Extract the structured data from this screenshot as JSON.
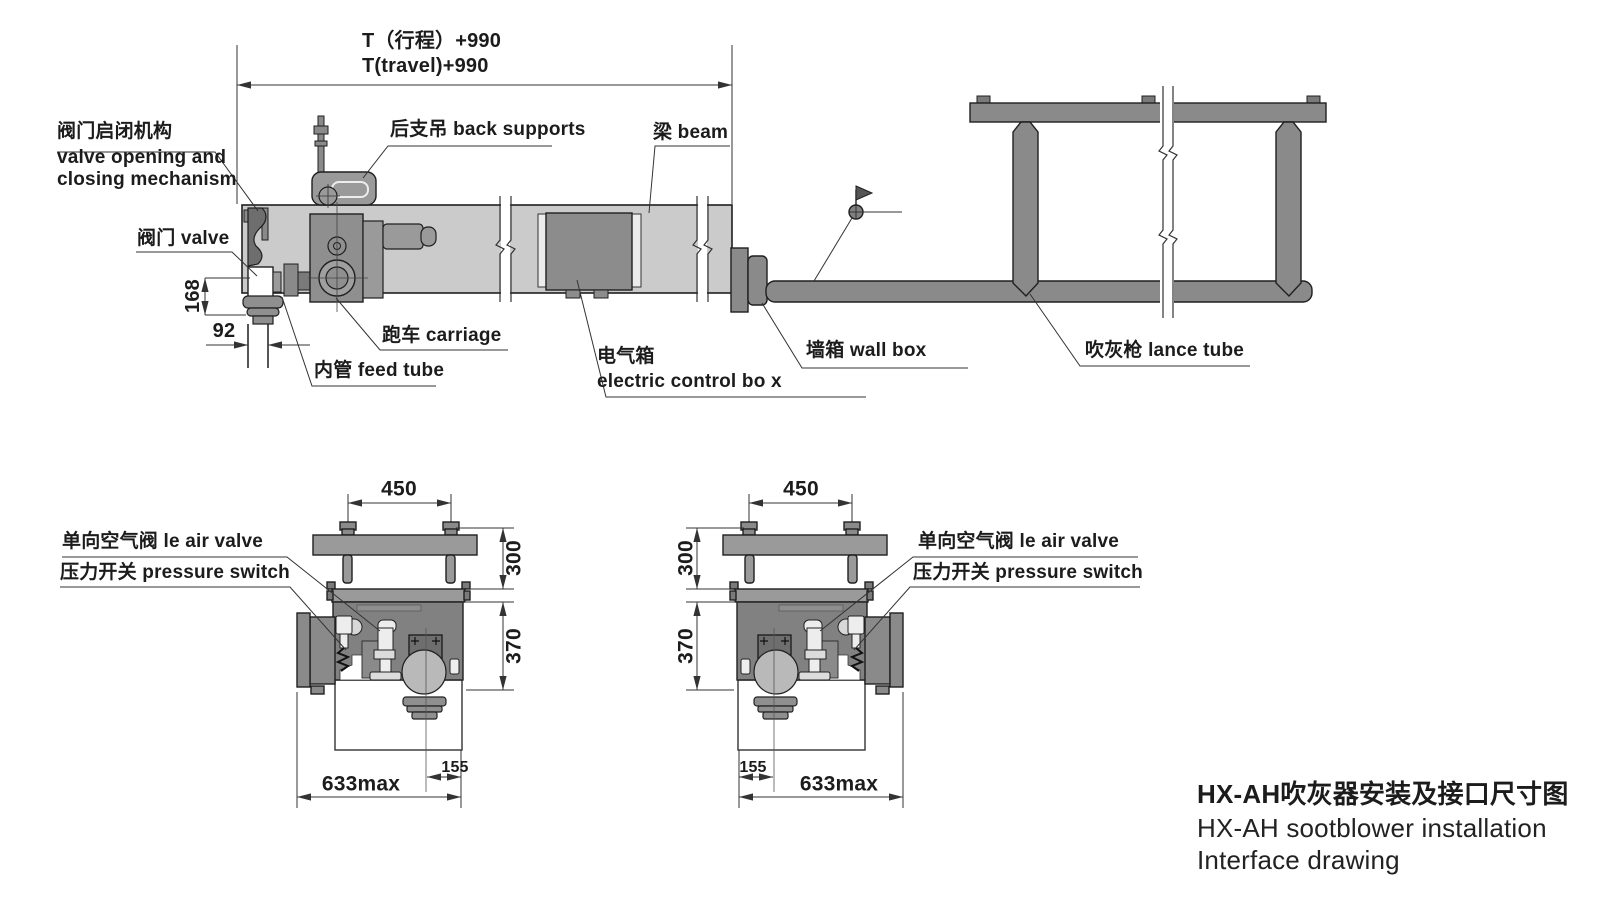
{
  "title_block": {
    "title_zh": "HX-AH吹灰器安装及接口尺寸图",
    "title_en_line1": "HX-AH sootblower installation",
    "title_en_line2": "Interface drawing"
  },
  "main_view": {
    "travel_dim_zh": "T（行程）+990",
    "travel_dim_en": "T(travel)+990",
    "labels": {
      "valve_mechanism_zh": "阀门启闭机构",
      "valve_mechanism_en_line1": "valve opening and",
      "valve_mechanism_en_line2": "closing mechanism",
      "valve": "阀门 valve",
      "back_supports": "后支吊 back supports",
      "beam": "梁 beam",
      "carriage": "跑车 carriage",
      "feed_tube": "内管 feed tube",
      "electric_box_zh": "电气箱",
      "electric_box_en": "electric control bo x",
      "wall_box": "墙箱 wall box",
      "lance_tube": "吹灰枪 lance tube"
    },
    "dims": {
      "valve_height": "168",
      "feed_tube_width": "92"
    }
  },
  "section_views": {
    "labels": {
      "air_valve": "单向空气阀 le air valve",
      "pressure_switch": "压力开关 pressure switch"
    },
    "dims": {
      "bolt_spacing": "450",
      "plate_height": "300",
      "body_height": "370",
      "offset": "155",
      "max_width": "633max"
    }
  },
  "colors": {
    "beam_fill": "#cbcbcb",
    "part_fill": "#8a8a8a",
    "dark_part_fill": "#6e6e6e",
    "outline": "#1f1f1f",
    "dim_line": "#333333"
  }
}
